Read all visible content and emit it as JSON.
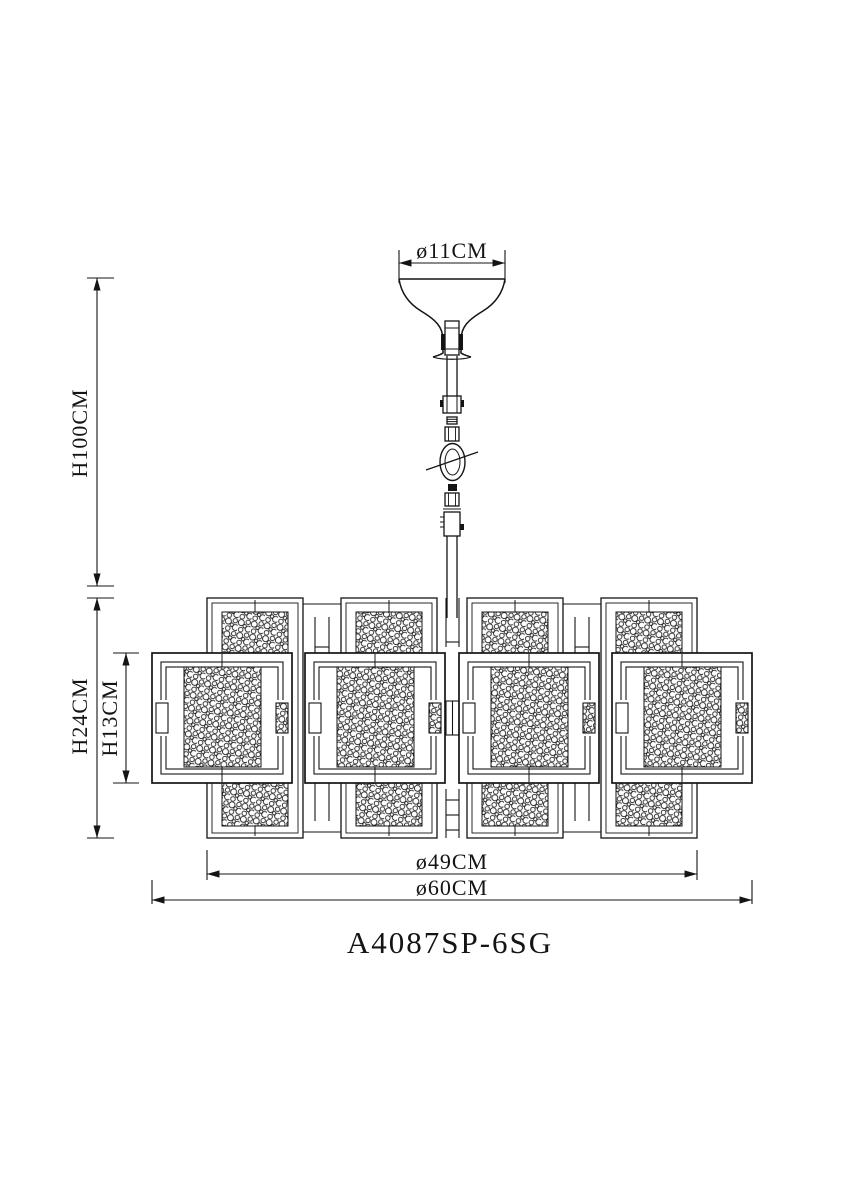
{
  "drawing": {
    "model": "A4087SP-6SG",
    "dimensions": {
      "canopy_diameter": "ø11CM",
      "overall_height": "H100CM",
      "body_height": "H24CM",
      "inner_body_height": "H13CM",
      "inner_diameter": "ø49CM",
      "overall_diameter": "ø60CM"
    },
    "colors": {
      "line": "#141414",
      "background": "#ffffff"
    }
  }
}
